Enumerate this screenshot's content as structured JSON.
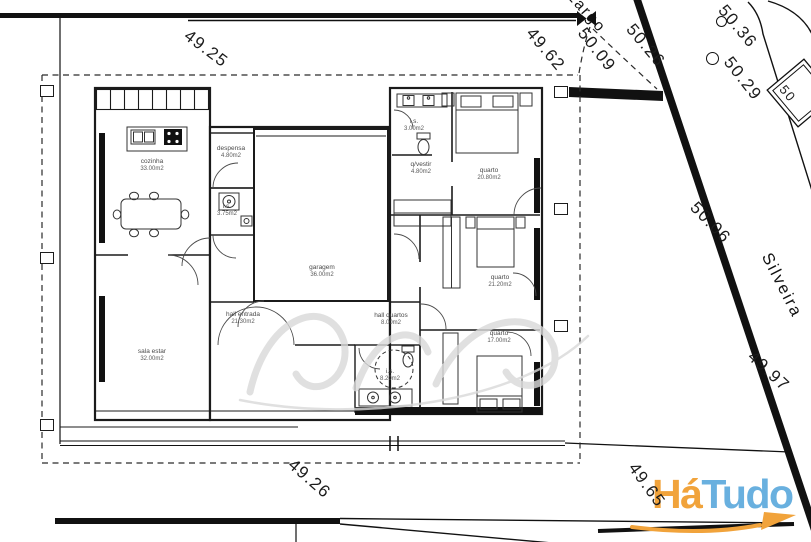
{
  "dims": {
    "top": "49.25",
    "northeast": "49.62",
    "east_upper": "50.06",
    "east_lower": "49.97",
    "south": "49.26",
    "southeast": "49.65"
  },
  "elevations": {
    "e1": "50.36",
    "e2": "50.29",
    "e3": "50.26",
    "e4": "50.09",
    "e5": "50"
  },
  "streets": {
    "top": "Largo",
    "right": "Silveira"
  },
  "rooms": [
    {
      "name": "cozinha",
      "area": "33.00m2"
    },
    {
      "name": "despensa",
      "area": "4.80m2"
    },
    {
      "name": "i.s.",
      "area": "3.75m2"
    },
    {
      "name": "garagem",
      "area": "36.00m2"
    },
    {
      "name": "hall entrada",
      "area": "21.30m2"
    },
    {
      "name": "sala estar",
      "area": "32.00m2"
    },
    {
      "name": "i.s.",
      "area": "3.00m2"
    },
    {
      "name": "q/vestir",
      "area": "4.80m2"
    },
    {
      "name": "quarto",
      "area": "20.80m2"
    },
    {
      "name": "quarto",
      "area": "21.20m2"
    },
    {
      "name": "hall quartos",
      "area": "8.00m2"
    },
    {
      "name": "i.s.",
      "area": "8.20m2"
    },
    {
      "name": "quarto",
      "area": "17.00m2"
    }
  ],
  "logo": {
    "part1": "Há",
    "part2": "Tudo",
    "color1": "#F1A33B",
    "color2": "#69B0DF"
  }
}
